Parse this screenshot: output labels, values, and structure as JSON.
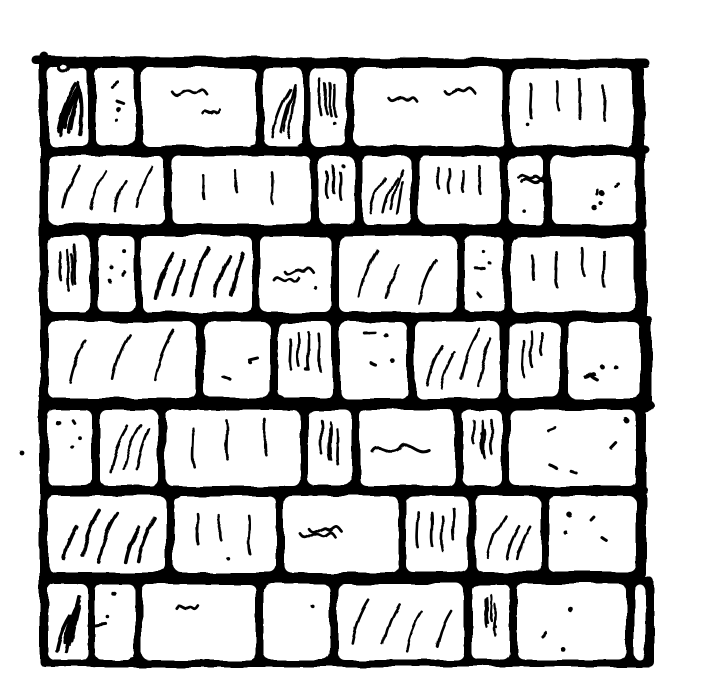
{
  "figure": {
    "description": "Black and white hand-drawn woodcut style illustration of a brick wall with seven courses of bricks, thick black mortar joints, a rough ink frame line along the top and left edges, and sketchy hatch marks texturing the bricks",
    "kind": "illustration"
  },
  "style": {
    "ink_color": "#000000",
    "paper_color": "#ffffff",
    "brick_corner_radius": 7,
    "mortar_overhang": 7,
    "wall_left": 40
  },
  "canvas": {
    "width": 702,
    "height": 695
  },
  "frame": {
    "top_line": {
      "x1": 36,
      "y1": 60,
      "x2": 646,
      "y2": 64,
      "weight": 9
    },
    "left_line": {
      "x1": 44,
      "y1": 56,
      "x2": 44,
      "y2": 652,
      "weight": 9
    }
  },
  "stray_marks": [
    {
      "type": "dot",
      "x": 22,
      "y": 453,
      "r": 2.4
    },
    {
      "type": "ring",
      "x": 64,
      "y": 68,
      "r": 4.5
    }
  ],
  "right_edge_blobs": [
    {
      "x": 642,
      "y": 150,
      "rx": 8,
      "ry": 5
    },
    {
      "x": 644,
      "y": 406,
      "rx": 11,
      "ry": 7
    },
    {
      "x": 640,
      "y": 490,
      "rx": 8,
      "ry": 5
    }
  ],
  "wall": {
    "rows": [
      {
        "top": 68,
        "bottom": 146,
        "right_end": 638,
        "bricks": [
          [
            48,
            88,
            "diag-heavy"
          ],
          [
            96,
            135,
            "dots"
          ],
          [
            142,
            256,
            "squiggle"
          ],
          [
            264,
            303,
            "diag"
          ],
          [
            310,
            346,
            "vert"
          ],
          [
            354,
            503,
            "squiggle"
          ],
          [
            511,
            632,
            "vert"
          ]
        ]
      },
      {
        "top": 156,
        "bottom": 224,
        "right_end": 640,
        "bricks": [
          [
            48,
            164,
            "diag"
          ],
          [
            172,
            311,
            "vert"
          ],
          [
            319,
            354,
            "vert"
          ],
          [
            362,
            411,
            "diag"
          ],
          [
            419,
            501,
            "vert"
          ],
          [
            509,
            544,
            "squiggle"
          ],
          [
            552,
            636,
            "dots"
          ]
        ]
      },
      {
        "top": 236,
        "bottom": 312,
        "right_end": 640,
        "bricks": [
          [
            48,
            90,
            "vert"
          ],
          [
            98,
            135,
            "dots"
          ],
          [
            142,
            252,
            "diag-heavy"
          ],
          [
            260,
            331,
            "squiggle"
          ],
          [
            339,
            456,
            "diag"
          ],
          [
            464,
            503,
            "dots"
          ],
          [
            511,
            634,
            "vert"
          ]
        ]
      },
      {
        "top": 322,
        "bottom": 398,
        "right_end": 646,
        "bricks": [
          [
            48,
            196,
            "diag"
          ],
          [
            204,
            270,
            "dots"
          ],
          [
            278,
            332,
            "vert"
          ],
          [
            340,
            407,
            "dots"
          ],
          [
            415,
            500,
            "diag"
          ],
          [
            508,
            560,
            "vert"
          ],
          [
            568,
            640,
            "dots"
          ]
        ]
      },
      {
        "top": 410,
        "bottom": 486,
        "right_end": 640,
        "bricks": [
          [
            48,
            92,
            "dots"
          ],
          [
            100,
            158,
            "diag"
          ],
          [
            166,
            300,
            "vert"
          ],
          [
            308,
            352,
            "vert"
          ],
          [
            360,
            455,
            "scribble"
          ],
          [
            463,
            502,
            "vert"
          ],
          [
            510,
            636,
            "dots"
          ]
        ]
      },
      {
        "top": 496,
        "bottom": 572,
        "right_end": 640,
        "bricks": [
          [
            48,
            166,
            "diag-heavy"
          ],
          [
            174,
            276,
            "vert"
          ],
          [
            284,
            398,
            "squiggle"
          ],
          [
            406,
            468,
            "vert"
          ],
          [
            476,
            540,
            "diag"
          ],
          [
            548,
            636,
            "dots"
          ]
        ]
      },
      {
        "top": 584,
        "bottom": 660,
        "right_end": 648,
        "bricks": [
          [
            48,
            88,
            "diag-heavy"
          ],
          [
            95,
            135,
            "dots"
          ],
          [
            142,
            256,
            "squiggle"
          ],
          [
            264,
            330,
            "plain"
          ],
          [
            338,
            464,
            "diag"
          ],
          [
            472,
            510,
            "vert"
          ],
          [
            518,
            626,
            "dots"
          ],
          [
            634,
            645,
            "plain"
          ]
        ]
      }
    ]
  }
}
